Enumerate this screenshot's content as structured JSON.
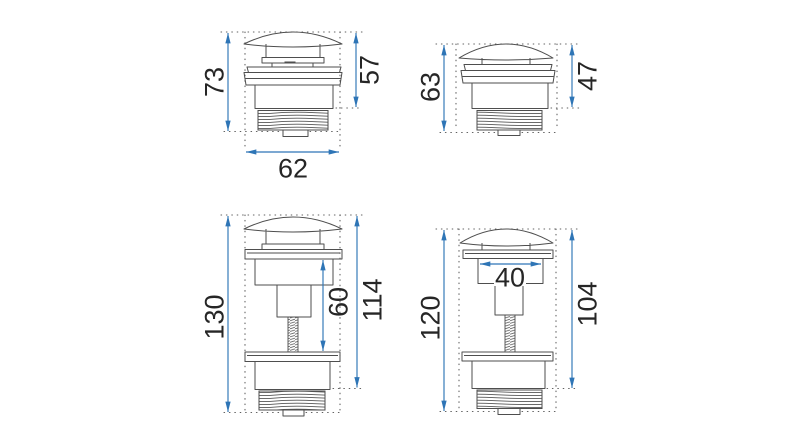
{
  "colors": {
    "bg-color": "#ffffff",
    "line-color": "#4e4e4e",
    "dim-color": "#2e75b6",
    "text-color": "#262626"
  },
  "drawings": {
    "top_left": {
      "total_height": "73",
      "body_height": "57",
      "width": "62"
    },
    "top_right": {
      "total_height": "63",
      "body_height": "47"
    },
    "bottom_left": {
      "total_height": "130",
      "rod_length": "60",
      "body_height": "114"
    },
    "bottom_right": {
      "total_height": "120",
      "cap_width": "40",
      "body_height": "104"
    }
  }
}
